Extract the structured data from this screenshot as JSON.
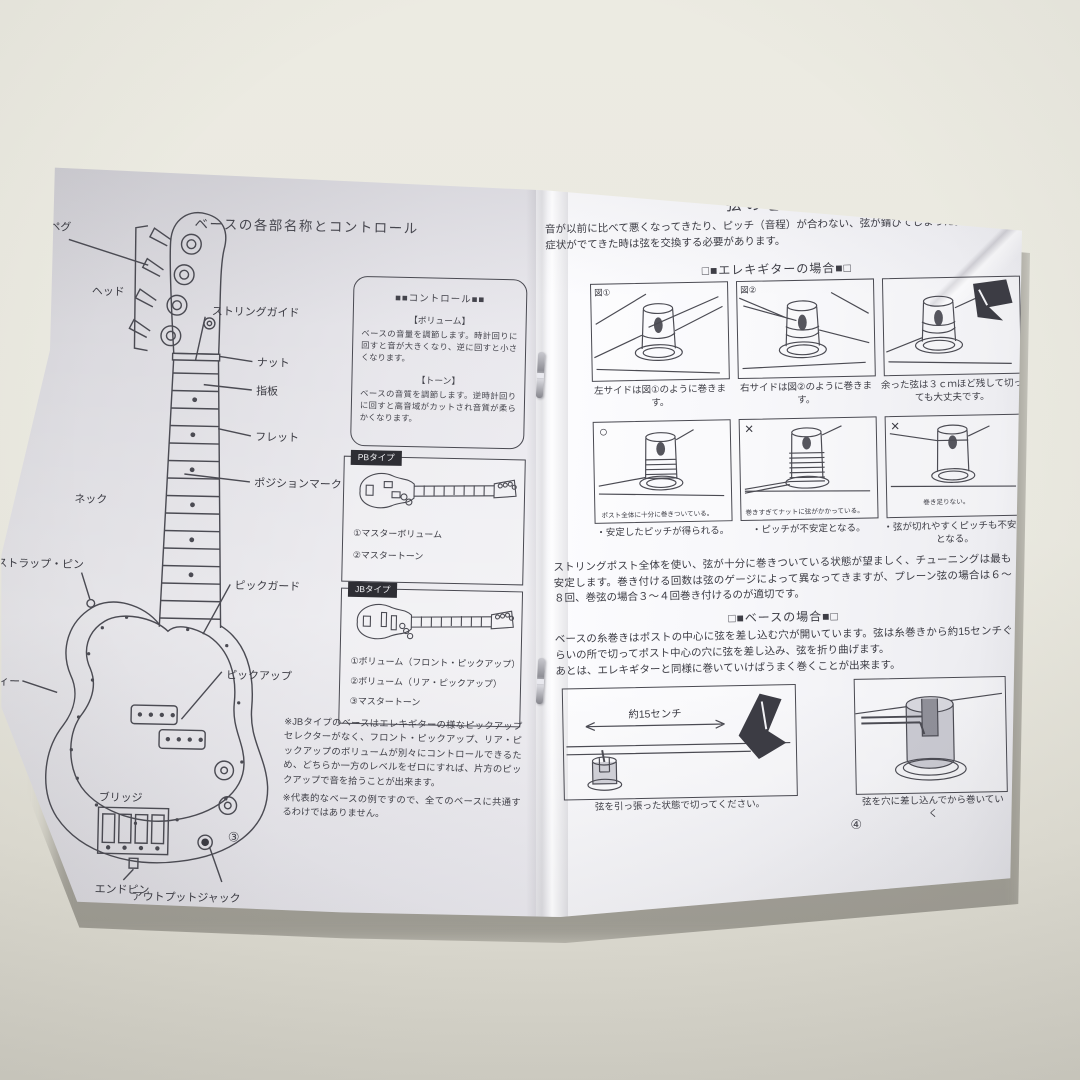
{
  "colors": {
    "paper": "#f4f4f7",
    "table": "#e9e7de",
    "ink": "#3d3d45"
  },
  "left_page": {
    "title": "ベースの各部名称とコントロール",
    "page_number": "③",
    "diagram_labels": {
      "peg": "ペグ",
      "head": "ヘッド",
      "string_guide": "ストリングガイド",
      "nut": "ナット",
      "fingerboard": "指板",
      "fret": "フレット",
      "neck": "ネック",
      "position_mark": "ポジションマーク",
      "strap_pin": "ストラップ・ピン",
      "body": "ボディー",
      "pickguard": "ピックガード",
      "pickup": "ピックアップ",
      "bridge": "ブリッジ",
      "end_pin": "エンドピン",
      "output_jack": "アウトプットジャック"
    },
    "control_box": {
      "title": "■■コントロール■■",
      "volume_heading": "【ボリューム】",
      "volume_text": "ベースの音量を調節します。時計回りに回すと音が大きくなり、逆に回すと小さくなります。",
      "tone_heading": "【トーン】",
      "tone_text": "ベースの音質を調節します。逆時計回りに回すと高音域がカットされ音質が柔らかくなります。"
    },
    "pb_type": {
      "tag": "PBタイプ",
      "items": [
        "①マスターボリューム",
        "②マスタートーン"
      ]
    },
    "jb_type": {
      "tag": "JBタイプ",
      "items": [
        "①ボリューム（フロント・ピックアップ）",
        "②ボリューム（リア・ピックアップ）",
        "③マスタートーン"
      ]
    },
    "notes": [
      "※JBタイプのベースはエレキギターの様なピックアップセレクターがなく、フロント・ピックアップ、リア・ピックアップのボリュームが別々にコントロールできるため、どちらか一方のレベルをゼロにすれば、片方のピックアップで音を拾うことが出来ます。",
      "※代表的なベースの例ですので、全てのベースに共通するわけではありません。"
    ]
  },
  "right_page": {
    "title": "弦の巻き方",
    "intro": "音が以前に比べて悪くなってきたり、ピッチ（音程）が合わない、弦が錆びてしまった。この様な症状がでてきた時は弦を交換する必要があります。",
    "page_number": "④",
    "electric_guitar_section": {
      "heading": "□■エレキギターの場合■□",
      "steps": [
        {
          "figure_label": "図①",
          "caption": "左サイドは図①のように巻きます。"
        },
        {
          "figure_label": "図②",
          "caption": "右サイドは図②のように巻きます。"
        },
        {
          "caption": "余った弦は３ｃｍほど残して切っても大丈夫です。"
        }
      ],
      "examples": [
        {
          "mark": "○",
          "inner_caption": "ポスト全体に十分に巻きついている。",
          "result": "・安定したピッチが得られる。"
        },
        {
          "mark": "×",
          "inner_caption": "巻きすぎてナットに弦がかかっている。",
          "result": "・ピッチが不安定となる。"
        },
        {
          "mark": "×",
          "inner_caption": "巻き足りない。",
          "result": "・弦が切れやすくピッチも不安定となる。"
        }
      ],
      "body_text": "ストリングポスト全体を使い、弦が十分に巻きついている状態が望ましく、チューニングは最も安定します。巻き付ける回数は弦のゲージによって異なってきますが、プレーン弦の場合は６～８回、巻弦の場合３～４回巻き付けるのが適切です。"
    },
    "bass_section": {
      "heading": "□■ベースの場合■□",
      "body_text": "ベースの糸巻きはポストの中心に弦を差し込む穴が開いています。弦は糸巻きから約15センチぐらいの所で切ってポスト中心の穴に弦を差し込み、弦を折り曲げます。",
      "body_text2": "あとは、エレキギターと同様に巻いていけばうまく巻くことが出来ます。",
      "figures": [
        {
          "measure_label": "約15センチ",
          "caption": "弦を引っ張った状態で切ってください。"
        },
        {
          "caption": "弦を穴に差し込んでから巻いていく"
        }
      ]
    }
  }
}
